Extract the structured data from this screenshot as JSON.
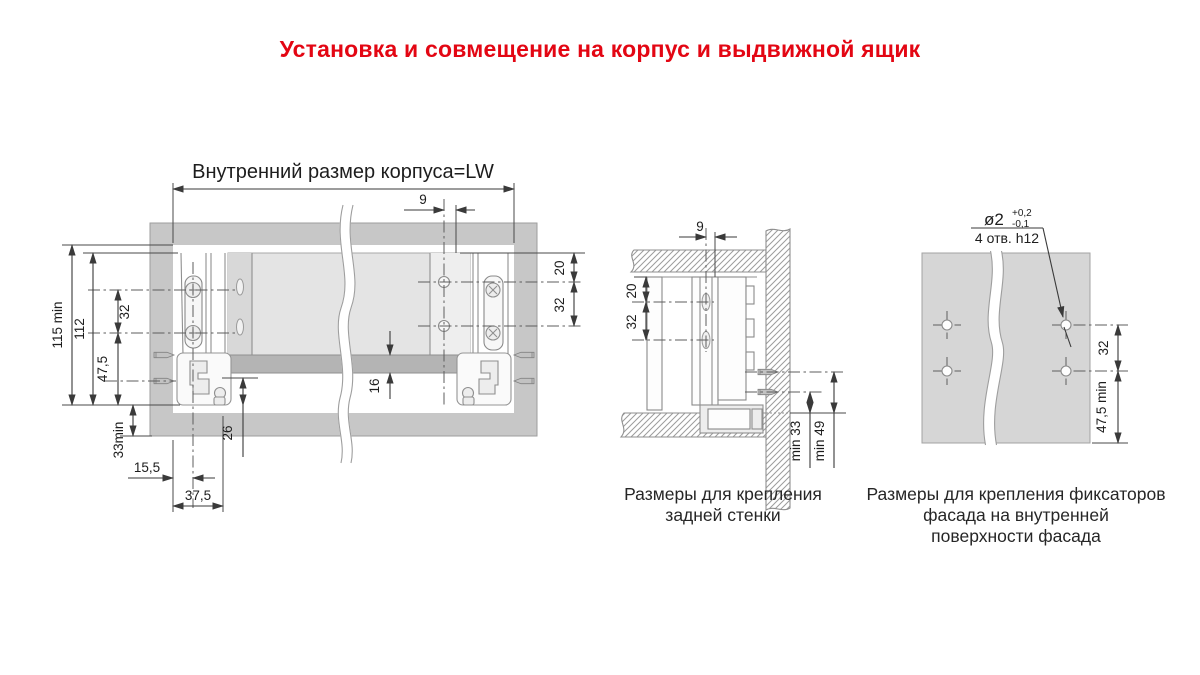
{
  "title": "Установка и совмещение на корпус и выдвижной ящик",
  "colors": {
    "title_red": "#e30613",
    "frame_gray": "#c7c7c7",
    "panel_gray": "#e4e4e4",
    "bar_gray": "#b4b4b4",
    "facade_gray": "#d6d6d6",
    "outline": "#8f8f8f",
    "dim_line": "#3a3a3a",
    "text": "#1d1d1d"
  },
  "main_view": {
    "top_label": "Внутренний размер корпуса=LW",
    "dims": {
      "offset_9": "9",
      "right_20": "20",
      "right_32": "32",
      "left_115": "115 min",
      "left_112": "112",
      "left_32": "32",
      "left_47_5": "47,5",
      "left_33": "33min",
      "bottom_15_5": "15,5",
      "bottom_37_5": "37,5",
      "bottom_26": "26",
      "bar_16": "16"
    }
  },
  "back_view": {
    "dims": {
      "offset_9": "9",
      "top_20": "20",
      "holes_32": "32",
      "min_33": "min 33",
      "min_49": "min 49"
    },
    "caption": [
      "Размеры для крепления",
      "задней стенки"
    ]
  },
  "facade_view": {
    "hole_spec": {
      "diameter": "ø2",
      "tol_plus": "+0,2",
      "tol_minus": "-0,1",
      "holes_note": "4 отв. h12"
    },
    "dims": {
      "holes_32": "32",
      "bottom_47_5": "47,5 min"
    },
    "caption": [
      "Размеры для крепления фиксаторов",
      "фасада на внутренней",
      "поверхности фасада"
    ]
  }
}
